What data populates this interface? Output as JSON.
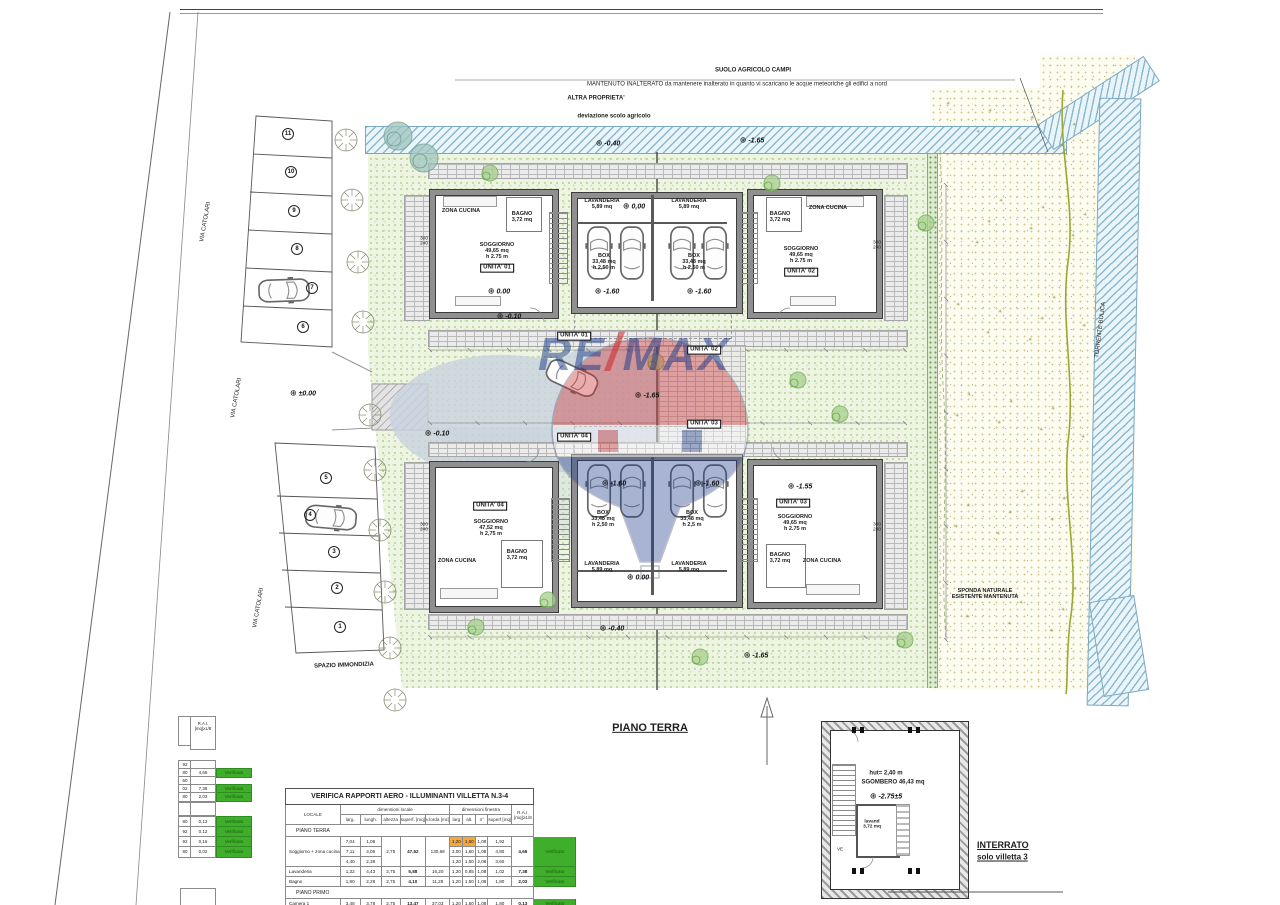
{
  "watermark": {
    "re": "RE",
    "slash": "/",
    "max": "MAX"
  },
  "labels": [
    {
      "n": "note-suolo-agricolo",
      "t": [
        "SUOLO AGRICOLO CAMPI"
      ],
      "x": 753,
      "y": 71,
      "s": 6,
      "b": 1
    },
    {
      "n": "note-mantenuto",
      "t": [
        "MANTENUTO INALTERATO da mantenere inalterato in quanto vi scaricano le acque meteoriche gli edifici a nord"
      ],
      "x": 737,
      "y": 85,
      "s": 6
    },
    {
      "n": "note-altra-proprieta",
      "t": [
        "ALTRA PROPRIETA'"
      ],
      "x": 596,
      "y": 99,
      "s": 6,
      "b": 1
    },
    {
      "n": "note-deviazione-scolo",
      "t": [
        "deviazione scolo agricolo"
      ],
      "x": 614,
      "y": 117,
      "s": 6,
      "b": 1
    },
    {
      "n": "road-via-catolari-1",
      "t": [
        "VIA CATOLARI"
      ],
      "x": 206,
      "y": 222,
      "s": 6,
      "r": -80
    },
    {
      "n": "road-via-catolari-2",
      "t": [
        "VIA CATOLARI"
      ],
      "x": 237,
      "y": 398,
      "s": 6,
      "r": -80
    },
    {
      "n": "road-via-catolari-3",
      "t": [
        "VIA CATOLARI"
      ],
      "x": 259,
      "y": 608,
      "s": 6,
      "r": -80
    },
    {
      "n": "spazio-immondizia",
      "t": [
        "SPAZIO IMMONDIZIA"
      ],
      "x": 344,
      "y": 666,
      "s": 6,
      "b": 1,
      "r": -2
    },
    {
      "n": "sponda-naturale",
      "t": [
        "SPONDA NATURALE",
        "ESISTENTE MANTENUTA"
      ],
      "x": 985,
      "y": 594,
      "s": 5.5,
      "b": 1
    },
    {
      "n": "torrente-label",
      "t": [
        "TORRENTE BULICA"
      ],
      "x": 1101,
      "y": 330,
      "s": 6,
      "r": -83
    },
    {
      "n": "piano-terra-title",
      "t": [
        "PIANO TERRA"
      ],
      "x": 650,
      "y": 728,
      "s": 11,
      "b": 1,
      "u": 1
    },
    {
      "n": "interrato-title",
      "t": [
        "INTERRATO"
      ],
      "x": 977,
      "y": 845,
      "s": 9,
      "b": 1,
      "u": 1,
      "a": "l"
    },
    {
      "n": "interrato-subtitle",
      "t": [
        "solo villetta 3"
      ],
      "x": 977,
      "y": 858,
      "s": 8,
      "b": 1,
      "u": 1,
      "a": "l"
    },
    {
      "n": "interrato-height",
      "t": [
        "hut= 2,40 m"
      ],
      "x": 886,
      "y": 774,
      "s": 6,
      "b": 1
    },
    {
      "n": "interrato-sgombero",
      "t": [
        "SGOMBERO 46,43 mq"
      ],
      "x": 893,
      "y": 783,
      "s": 6,
      "b": 1
    },
    {
      "n": "interrato-lavanderia",
      "t": [
        "lavand",
        "3,72 mq"
      ],
      "x": 872,
      "y": 825,
      "s": 4.8,
      "b": 1
    },
    {
      "n": "interrato-ve",
      "t": [
        "VE"
      ],
      "x": 840,
      "y": 849,
      "s": 4.5
    },
    {
      "n": "u1-zona-cucina",
      "t": [
        "ZONA CUCINA"
      ],
      "x": 461,
      "y": 211,
      "s": 5.5,
      "b": 1
    },
    {
      "n": "u1-bagno",
      "t": [
        "BAGNO",
        "3,72 mq"
      ],
      "x": 522,
      "y": 217,
      "s": 5.5,
      "b": 1
    },
    {
      "n": "u1-soggiorno",
      "t": [
        "SOGGIORNO",
        "49,65 mq",
        "h 2.75 m"
      ],
      "x": 497,
      "y": 251,
      "s": 5.5,
      "b": 1
    },
    {
      "n": "u1-tag",
      "t": [
        "UNITA'  01"
      ],
      "x": 497,
      "y": 268,
      "s": 6,
      "bx": 1
    },
    {
      "n": "g1l-lavanderia",
      "t": [
        "LAVANDERIA",
        "5,89 mq"
      ],
      "x": 602,
      "y": 204,
      "s": 5.5,
      "b": 1
    },
    {
      "n": "g1l-box",
      "t": [
        "BOX",
        "33,48 mq",
        "h 2,50 m"
      ],
      "x": 604,
      "y": 262,
      "s": 5.5,
      "b": 1
    },
    {
      "n": "g1r-lavanderia",
      "t": [
        "LAVANDERIA",
        "5,89 mq"
      ],
      "x": 689,
      "y": 204,
      "s": 5.5,
      "b": 1
    },
    {
      "n": "g1r-box",
      "t": [
        "BOX",
        "33,48 mq",
        "h 2,50 m"
      ],
      "x": 694,
      "y": 262,
      "s": 5.5,
      "b": 1
    },
    {
      "n": "u2-bagno",
      "t": [
        "BAGNO",
        "3,72 mq"
      ],
      "x": 780,
      "y": 217,
      "s": 5.5,
      "b": 1
    },
    {
      "n": "u2-zona-cucina",
      "t": [
        "ZONA CUCINA"
      ],
      "x": 828,
      "y": 208,
      "s": 5.5,
      "b": 1
    },
    {
      "n": "u2-soggiorno",
      "t": [
        "SOGGIORNO",
        "49,65 mq",
        "h 2.75 m"
      ],
      "x": 801,
      "y": 255,
      "s": 5.5,
      "b": 1
    },
    {
      "n": "u2-tag",
      "t": [
        "UNITA'  02"
      ],
      "x": 801,
      "y": 272,
      "s": 6,
      "bx": 1
    },
    {
      "n": "site-tag-unita-01",
      "t": [
        "UNITA'  01"
      ],
      "x": 574,
      "y": 336,
      "s": 6,
      "bx": 1
    },
    {
      "n": "site-tag-unita-02",
      "t": [
        "UNITA'  02"
      ],
      "x": 704,
      "y": 350,
      "s": 6,
      "bx": 1
    },
    {
      "n": "site-tag-unita-03",
      "t": [
        "UNITA'  03"
      ],
      "x": 704,
      "y": 424,
      "s": 6,
      "bx": 1
    },
    {
      "n": "site-tag-unita-04",
      "t": [
        "UNITA'  04"
      ],
      "x": 574,
      "y": 437,
      "s": 6,
      "bx": 1
    },
    {
      "n": "u4-tag",
      "t": [
        "UNITA'  04"
      ],
      "x": 490,
      "y": 506,
      "s": 6,
      "bx": 1
    },
    {
      "n": "u4-soggiorno",
      "t": [
        "SOGGIORNO",
        "47,52 mq",
        "h 2,75 m"
      ],
      "x": 491,
      "y": 528,
      "s": 5.5,
      "b": 1
    },
    {
      "n": "u4-zona-cucina",
      "t": [
        "ZONA CUCINA"
      ],
      "x": 457,
      "y": 561,
      "s": 5.5,
      "b": 1
    },
    {
      "n": "u4-bagno",
      "t": [
        "BAGNO",
        "3,72 mq"
      ],
      "x": 517,
      "y": 555,
      "s": 5.5,
      "b": 1
    },
    {
      "n": "g2l-box",
      "t": [
        "BOX",
        "33,48 mq",
        "h 2,50 m"
      ],
      "x": 603,
      "y": 519,
      "s": 5.5,
      "b": 1
    },
    {
      "n": "g2l-lavanderia",
      "t": [
        "LAVANDERIA",
        "5,89 mq"
      ],
      "x": 602,
      "y": 567,
      "s": 5.5,
      "b": 1
    },
    {
      "n": "g2r-box",
      "t": [
        "BOX",
        "33,48 mq",
        "h 2,5 m"
      ],
      "x": 692,
      "y": 519,
      "s": 5.5,
      "b": 1
    },
    {
      "n": "g2r-lavanderia",
      "t": [
        "LAVANDERIA",
        "5,89 mq"
      ],
      "x": 689,
      "y": 567,
      "s": 5.5,
      "b": 1
    },
    {
      "n": "u3-tag",
      "t": [
        "UNITA'  03"
      ],
      "x": 793,
      "y": 503,
      "s": 6,
      "bx": 1
    },
    {
      "n": "u3-soggiorno",
      "t": [
        "SOGGIORNO",
        "49,65 mq",
        "h 2.75 m"
      ],
      "x": 795,
      "y": 523,
      "s": 5.5,
      "b": 1
    },
    {
      "n": "u3-bagno",
      "t": [
        "BAGNO",
        "3,72 mq"
      ],
      "x": 780,
      "y": 558,
      "s": 5.5,
      "b": 1
    },
    {
      "n": "u3-zona-cucina",
      "t": [
        "ZONA CUCINA"
      ],
      "x": 822,
      "y": 561,
      "s": 5.5,
      "b": 1
    }
  ],
  "elevations": [
    {
      "v": "-0.40",
      "x": 608,
      "y": 143
    },
    {
      "v": "-1.65",
      "x": 752,
      "y": 140
    },
    {
      "v": "0,00",
      "x": 634,
      "y": 206
    },
    {
      "v": "0.00",
      "x": 499,
      "y": 291
    },
    {
      "v": "-1.60",
      "x": 607,
      "y": 291
    },
    {
      "v": "-1.60",
      "x": 699,
      "y": 291
    },
    {
      "v": "-0.10",
      "x": 509,
      "y": 316
    },
    {
      "v": "±0.00",
      "x": 303,
      "y": 393
    },
    {
      "v": "-1.65",
      "x": 647,
      "y": 395
    },
    {
      "v": "-0.10",
      "x": 437,
      "y": 433
    },
    {
      "v": "-1.60",
      "x": 614,
      "y": 483
    },
    {
      "v": "-1.60",
      "x": 707,
      "y": 483
    },
    {
      "v": "-1.55",
      "x": 800,
      "y": 486
    },
    {
      "v": "0.00",
      "x": 638,
      "y": 577
    },
    {
      "v": "-0.40",
      "x": 612,
      "y": 628
    },
    {
      "v": "-1.65",
      "x": 756,
      "y": 655
    },
    {
      "v": "-2.75±5",
      "x": 886,
      "y": 796
    }
  ],
  "dims": [
    {
      "t": [
        "300",
        "240"
      ],
      "x": 424,
      "y": 242
    },
    {
      "t": [
        "300",
        "240"
      ],
      "x": 877,
      "y": 246
    },
    {
      "t": [
        "300",
        "240"
      ],
      "x": 424,
      "y": 528
    },
    {
      "t": [
        "300",
        "240"
      ],
      "x": 877,
      "y": 528
    }
  ],
  "parking": {
    "top_numbers": [
      "11",
      "10",
      "9",
      "8",
      "7",
      "6"
    ],
    "bottom_numbers": [
      "5",
      "4",
      "3",
      "2",
      "1"
    ]
  },
  "verification_table": {
    "title": "VERIFICA RAPPORTI AERO - ILLUMINANTI   VILLETTA N.3-4",
    "locale_header": "LOCALE",
    "group_local": "dimensioni locale",
    "group_finestra": "dimensioni finestra",
    "rai_header_1": "R.A.I.",
    "rai_header_2": "[mq]≥1/8",
    "subheaders": [
      "larg.",
      "lungh.",
      "altezza",
      "superf. [mq]",
      "v.lorda [mc]",
      "larg",
      "alt.",
      "n°",
      "superf [mq]"
    ],
    "rows": [
      {
        "type": "section",
        "label": "PIANO TERRA"
      },
      {
        "type": "room",
        "label": "Soggiorno + zona cucina",
        "local": [
          [
            "7,04",
            "1,08"
          ],
          [
            "7,11",
            "4,06"
          ],
          [
            "4,40",
            "2,38"
          ]
        ],
        "altezza": "2,75",
        "superf": "47,52",
        "vlorda": "130,68",
        "fin": [
          {
            "c": [
              "1,20",
              "1,60",
              "1,08",
              "1,92"
            ],
            "hl": true
          },
          {
            "c": [
              "3,00",
              "1,60",
              "1,08",
              "4,80"
            ]
          },
          {
            "c": [
              "1,20",
              "1,50",
              "2,08",
              "3,60"
            ]
          }
        ],
        "rai": "4,66",
        "verdict": "Verificato"
      },
      {
        "type": "room",
        "label": "Lavanderia",
        "local": [
          [
            "1,32",
            "4,43"
          ]
        ],
        "altezza": "2,75",
        "superf": "5,88",
        "vlorda": "16,20",
        "fin": [
          {
            "c": [
              "1,20",
              "0,85",
              "1,08",
              "1,02"
            ]
          }
        ],
        "rai": "7,38",
        "verdict": "Verificato"
      },
      {
        "type": "room",
        "label": "Bagno",
        "local": [
          [
            "1,80",
            "2,28"
          ]
        ],
        "altezza": "2,75",
        "superf": "4,10",
        "vlorda": "11,28",
        "fin": [
          {
            "c": [
              "1,20",
              "1,50",
              "1,08",
              "1,80"
            ]
          }
        ],
        "rai": "2,03",
        "verdict": "Verificato"
      },
      {
        "type": "section",
        "label": "PIANO PRIMO"
      },
      {
        "type": "room",
        "label": "Camera 1",
        "local": [
          [
            "3,48",
            "3,78"
          ]
        ],
        "altezza": "2,75",
        "superf": "13,47",
        "vlorda": "37,03",
        "fin": [
          {
            "c": [
              "1,20",
              "1,50",
              "1,08",
              "1,80"
            ]
          }
        ],
        "rai": "0,13",
        "verdict": "Verificato"
      },
      {
        "type": "room",
        "label": "",
        "local": [
          [
            "",
            ""
          ]
        ],
        "altezza": "",
        "superf": "",
        "vlorda": "",
        "fin": [
          {
            "c": [
              "",
              "",
              "",
              ""
            ],
            "hl": true
          }
        ],
        "rai": "",
        "verdict": ""
      }
    ]
  },
  "left_table": {
    "header1": "R.A.I.",
    "header2": "[mq]≥1/8",
    "verdict_label": "Verificato",
    "rows": [
      {
        "frag": "92",
        "rai": "",
        "verdict": ""
      },
      {
        "frag": "80",
        "rai": "4,66",
        "verdict": "Verificato"
      },
      {
        "frag": "60",
        "rai": "",
        "verdict": ""
      },
      {
        "frag": "02",
        "rai": "7,38",
        "verdict": "Verificato"
      },
      {
        "frag": "80",
        "rai": "2,03",
        "verdict": "Verificato"
      },
      {
        "frag": "",
        "rai": "",
        "verdict": ""
      },
      {
        "frag": "80",
        "rai": "0,13",
        "verdict": "Verificato"
      },
      {
        "frag": "92",
        "rai": "0,12",
        "verdict": "Verificato"
      },
      {
        "frag": "92",
        "rai": "0,16",
        "verdict": "Verificato"
      },
      {
        "frag": "80",
        "rai": "0,02",
        "verdict": "Verificato"
      }
    ]
  }
}
